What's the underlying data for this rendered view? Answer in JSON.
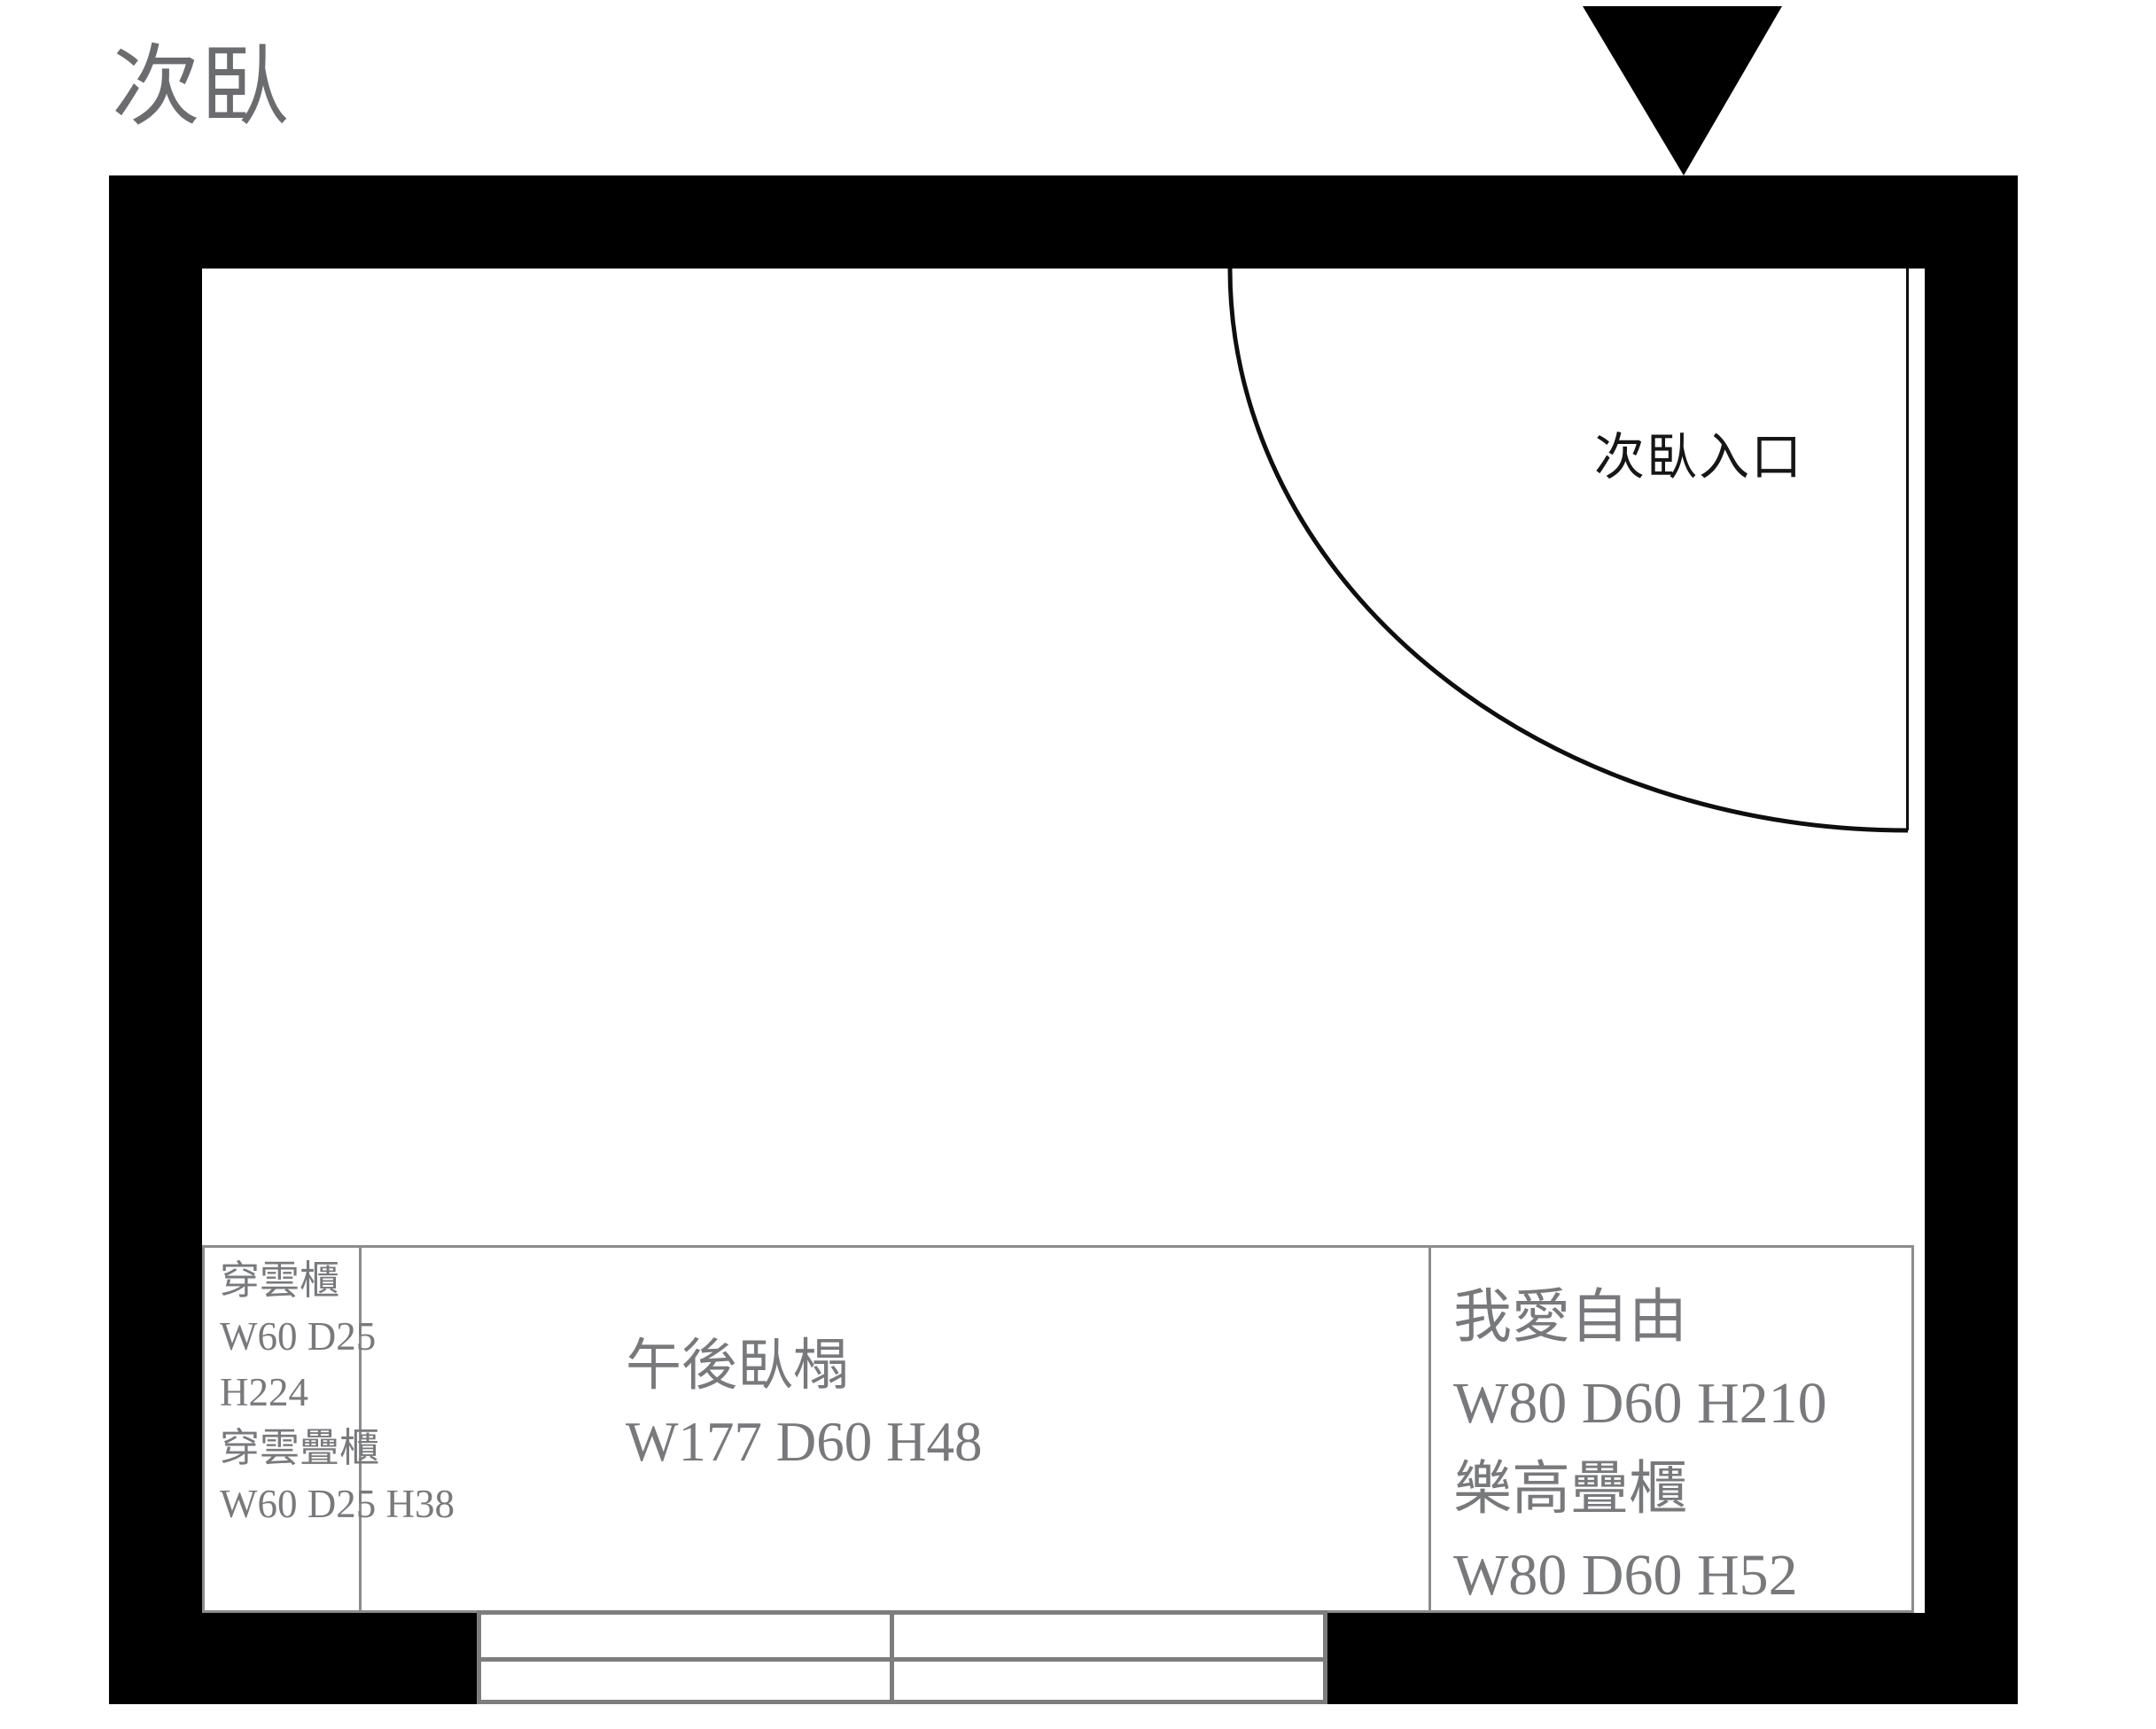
{
  "page": {
    "title": "次臥"
  },
  "door": {
    "entrance_label": "次臥入口"
  },
  "furniture": {
    "left_cabinet": {
      "lines": [
        "穿雲櫃",
        "W60 D25",
        "H224",
        "穿雲疊櫃",
        "W60 D25 H38"
      ]
    },
    "daybed": {
      "lines": [
        "午後臥榻",
        "W177 D60 H48"
      ]
    },
    "right_cabinet": {
      "lines": [
        "我愛自由",
        "W80 D60 H210",
        "樂高疊櫃",
        "W80 D60 H52"
      ]
    }
  },
  "colors": {
    "wall": "#000000",
    "title_text": "#6b6c6f",
    "entrance_text": "#161616",
    "furniture_text": "#78797c",
    "outline_gray": "#8c8c8c",
    "window_gray": "#7d7d7d"
  }
}
